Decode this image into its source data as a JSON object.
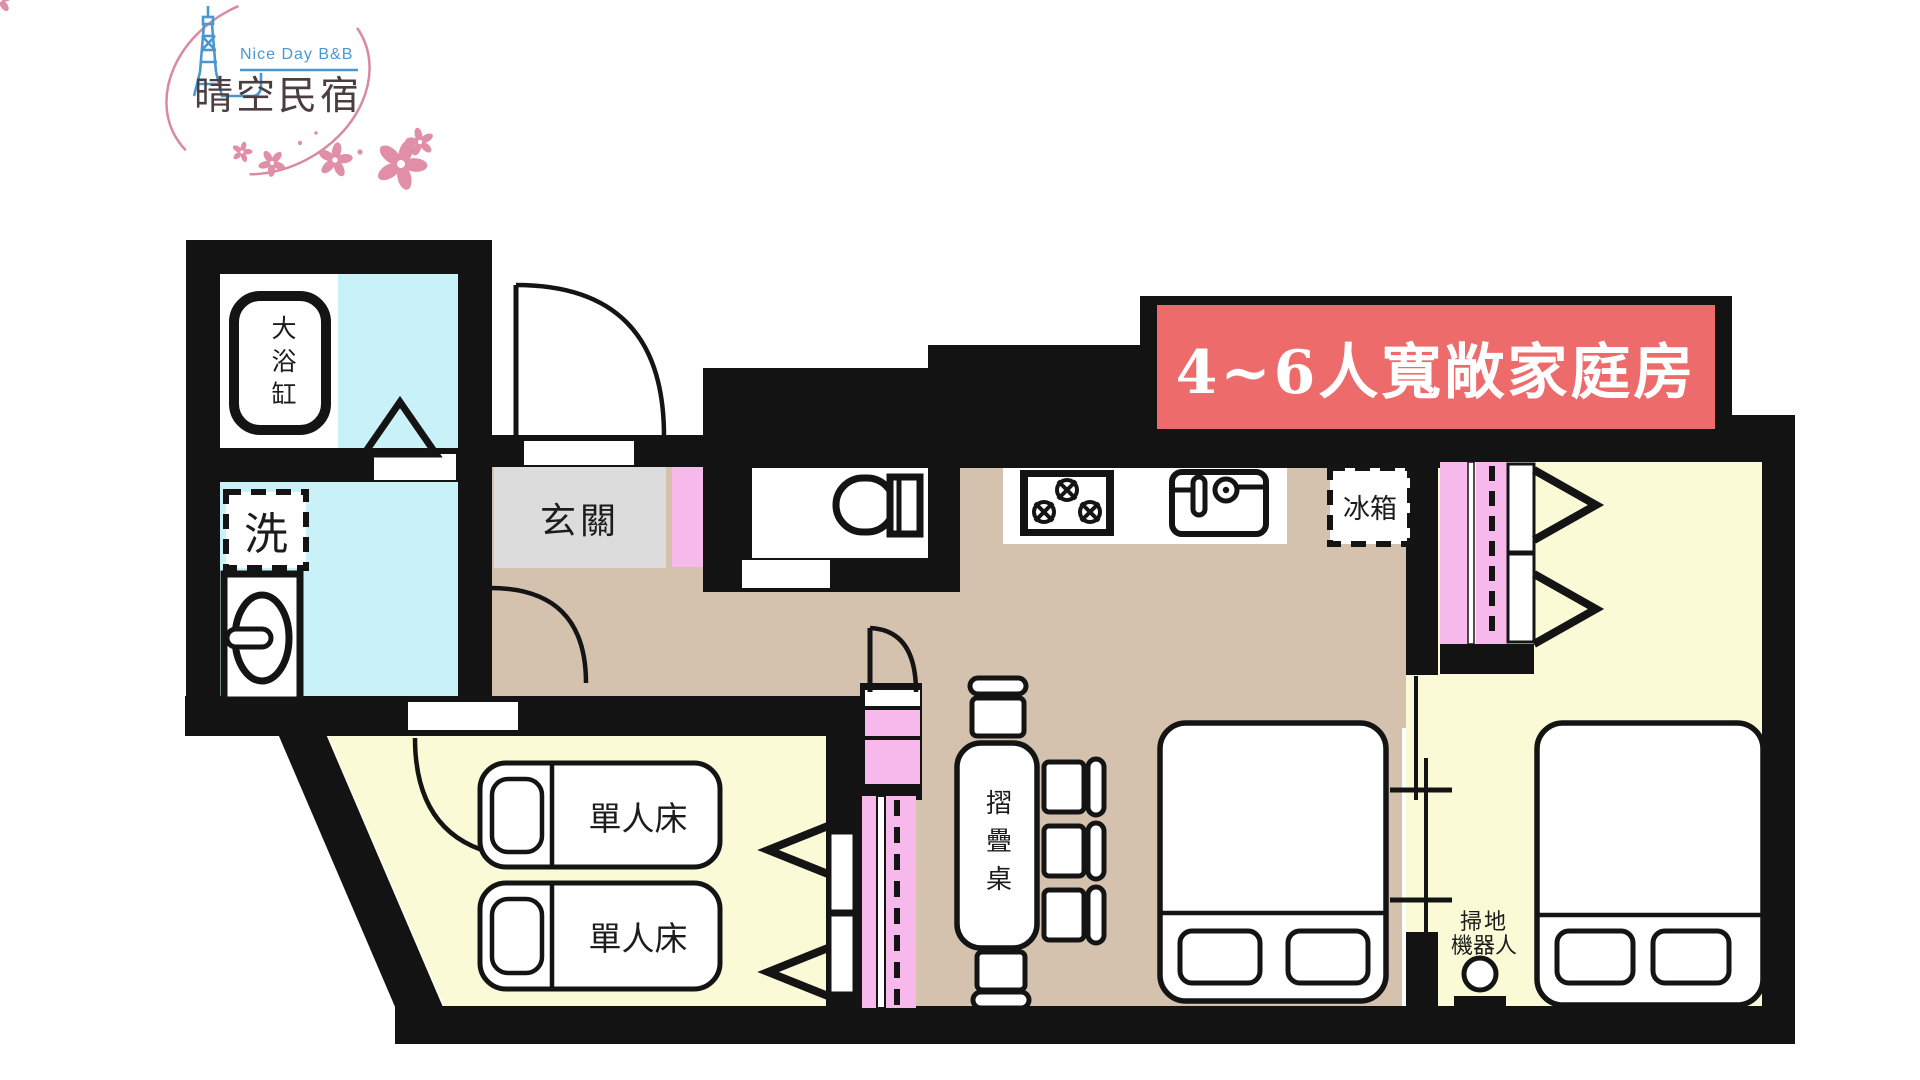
{
  "logo": {
    "brand_en": "Nice Day B&B",
    "brand_zh": "晴空民宿",
    "tower_icon": "skytree-tower-icon",
    "flower_icon": "sakura-flower-icon",
    "colors": {
      "blue": "#4a97cf",
      "pink": "#dd8fa5",
      "text": "#4a3e40"
    }
  },
  "banner": {
    "label": "4~6人寬敞家庭房",
    "bg": "#ee6b6b",
    "fg": "#ffffff"
  },
  "plan": {
    "labels": {
      "bathtub": "大浴缸",
      "wash": "洗",
      "entry": "玄關",
      "fridge": "冰箱",
      "single_bed_a": "單人床",
      "single_bed_b": "單人床",
      "folding_table": "摺疊桌",
      "robot_line1": "掃地",
      "robot_line2": "機器人"
    },
    "colors": {
      "wall": "#131313",
      "bath_floor": "#c9f2f8",
      "entry_floor": "#dcdcdc",
      "wood_floor": "#d4c2ae",
      "bedroom_floor": "#fafbd6",
      "cabinet_pink": "#f7b9ec"
    },
    "icons": [
      "bathtub-icon",
      "washing-machine-icon",
      "basin-icon",
      "shower-icon",
      "toilet-icon",
      "stove-icon",
      "kitchen-sink-icon",
      "fridge-icon",
      "door-swing-icon",
      "sliding-door-icon",
      "folding-table-icon",
      "chair-icon",
      "double-bed-icon",
      "single-bed-icon",
      "wardrobe-icon",
      "robot-vacuum-icon"
    ]
  }
}
